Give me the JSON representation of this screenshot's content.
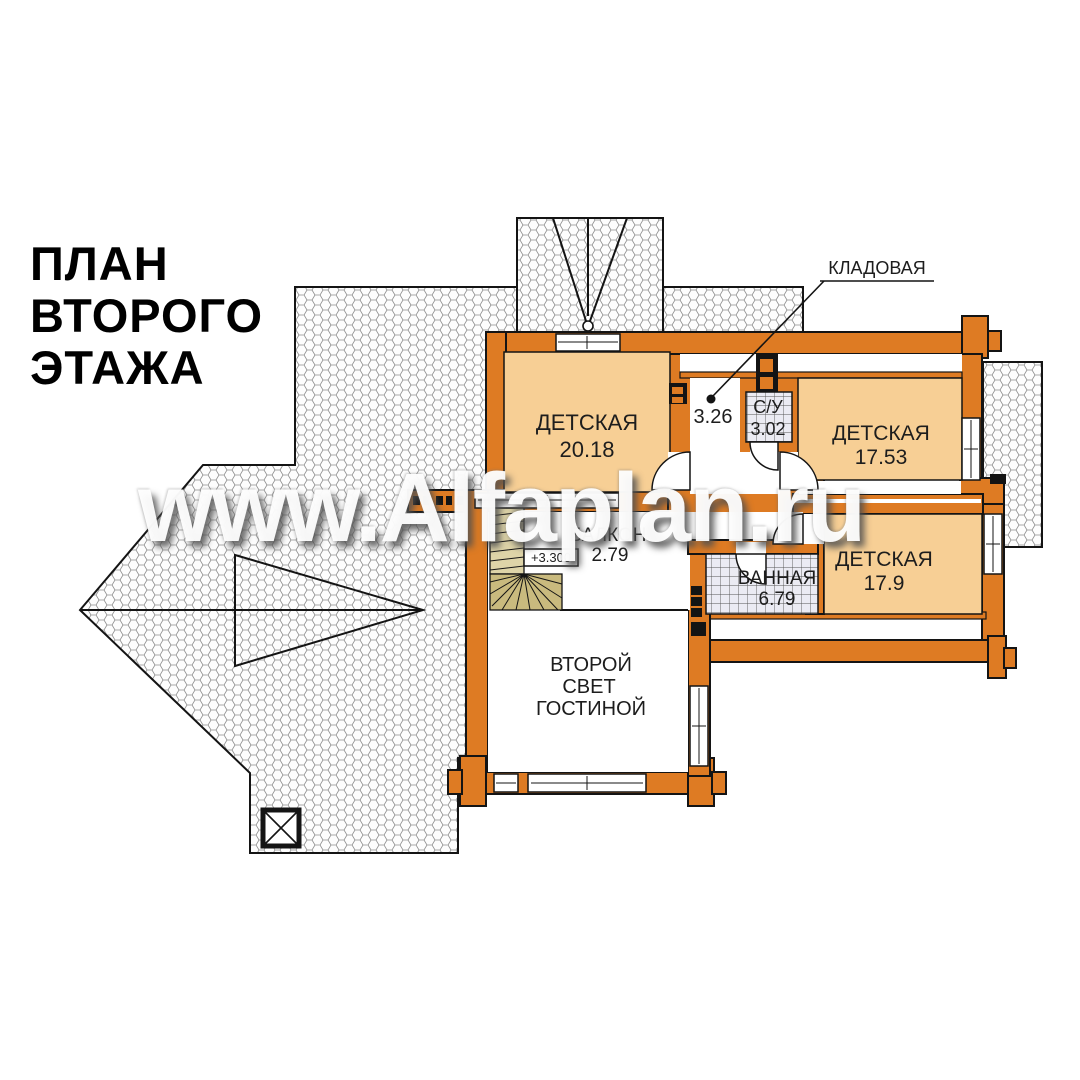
{
  "title": {
    "line1": "ПЛАН",
    "line2": "ВТОРОГО",
    "line3": "ЭТАЖА"
  },
  "watermark": {
    "text": "www.Alfaplan.ru"
  },
  "callout": {
    "label": "КЛАДОВАЯ"
  },
  "elevation": {
    "mark": "+3.300"
  },
  "rooms": {
    "nursery1": {
      "name": "ДЕТСКАЯ",
      "area": "20.18"
    },
    "hall": {
      "area": "3.26"
    },
    "wc": {
      "name": "С/У",
      "area": "3.02"
    },
    "nursery2": {
      "name": "ДЕТСКАЯ",
      "area": "17.53"
    },
    "nursery3": {
      "name": "ДЕТСКАЯ",
      "area": "17.9"
    },
    "bath": {
      "name": "ВАННАЯ",
      "area": "6.79"
    },
    "balcony": {
      "name": "БАЛКОН",
      "area": "2.79"
    },
    "void": {
      "line1": "ВТОРОЙ",
      "line2": "СВЕТ",
      "line3": "ГОСТИНОЙ"
    }
  },
  "colors": {
    "wall": "#de7b23",
    "room_fill": "#f7cf95",
    "stair_winder": "#c9ba7e",
    "stair_flight": "#ded4a8",
    "tile_bg": "#ebebf3",
    "outline": "#141414",
    "roof_hatch": "#8e8e8e"
  }
}
